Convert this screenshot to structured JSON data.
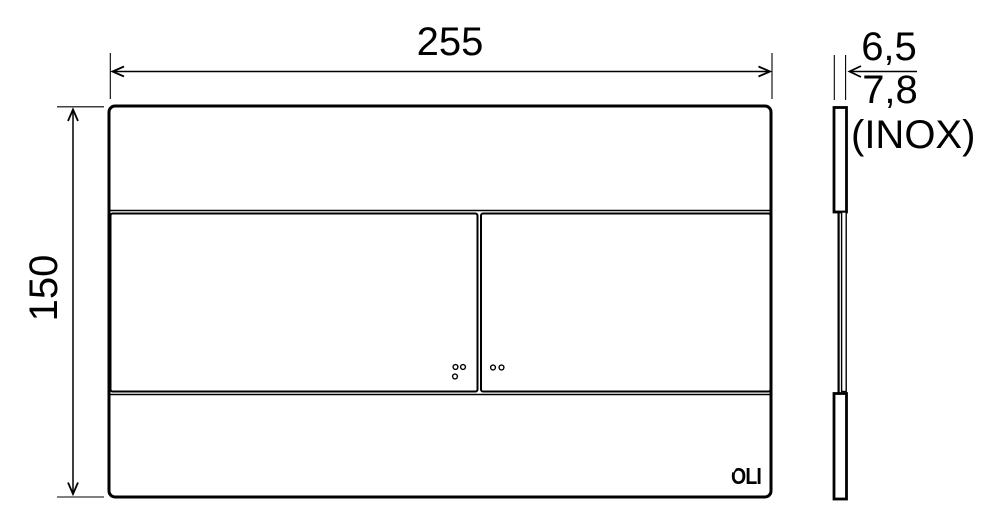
{
  "page": {
    "background_color": "#ffffff",
    "line_color": "#000000"
  },
  "front_view": {
    "width_dim": "255",
    "height_dim": "150",
    "brand_logo": "OLI",
    "large_button_dot_count": 3,
    "small_button_dot_count": 2
  },
  "side_view": {
    "thickness_dim": "6,5",
    "thickness_inox_dim": "7,8",
    "inox_note": "(INOX)"
  }
}
